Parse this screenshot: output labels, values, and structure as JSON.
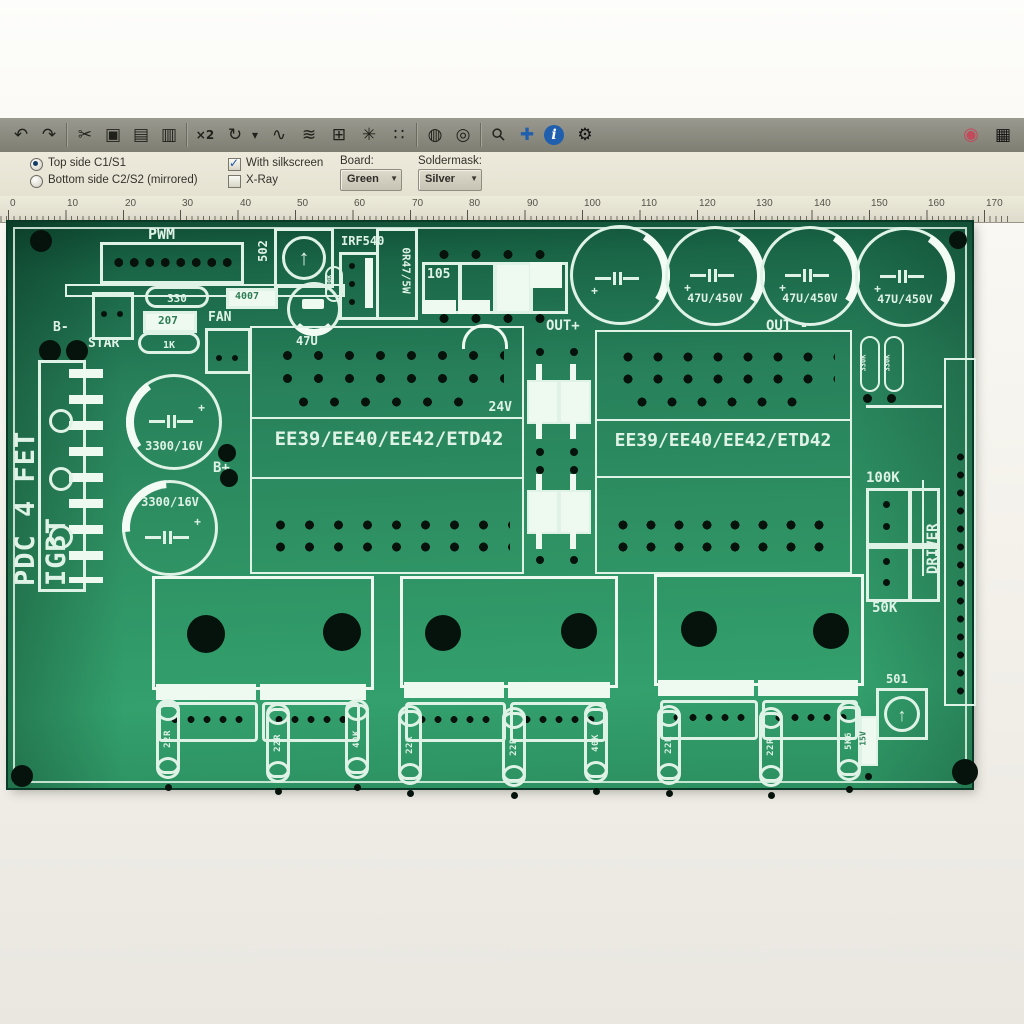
{
  "toolbar": {
    "icons": [
      {
        "name": "undo-icon",
        "glyph": "↶"
      },
      {
        "name": "redo-icon",
        "glyph": "↷"
      },
      {
        "name": "cut-icon",
        "glyph": "✂"
      },
      {
        "name": "copy-icon",
        "glyph": "▣"
      },
      {
        "name": "paste-icon",
        "glyph": "▤"
      },
      {
        "name": "delete-icon",
        "glyph": "▥"
      },
      {
        "name": "scale-x2-icon",
        "glyph": "×2"
      },
      {
        "name": "rotate-icon",
        "glyph": "↻"
      },
      {
        "name": "rotate-dropdown-arrow",
        "glyph": "▾"
      },
      {
        "name": "connection-icon",
        "glyph": "∿"
      },
      {
        "name": "ratsnest-icon",
        "glyph": "≋"
      },
      {
        "name": "route-icon",
        "glyph": "⊞"
      },
      {
        "name": "settings-asterisk-icon",
        "glyph": "✳"
      },
      {
        "name": "footprint-icon",
        "glyph": "∷"
      },
      {
        "name": "plane-icon",
        "glyph": "◍"
      },
      {
        "name": "plane-alt-icon",
        "glyph": "◎"
      },
      {
        "name": "zoom-icon",
        "glyph": "⚲"
      },
      {
        "name": "crosshair-icon",
        "glyph": "✚"
      },
      {
        "name": "info-icon",
        "glyph": "i"
      },
      {
        "name": "gear-icon",
        "glyph": "⚙"
      }
    ],
    "right_icons": [
      {
        "name": "record-icon",
        "glyph": "◉"
      },
      {
        "name": "panel-icon",
        "glyph": "▦"
      }
    ]
  },
  "options": {
    "radio_top": "Top side C1/S1",
    "radio_bottom": "Bottom side C2/S2 (mirrored)",
    "checkbox_silkscreen": "With silkscreen",
    "checkbox_xray": "X-Ray",
    "board_label": "Board:",
    "board_value": "Green",
    "soldermask_label": "Soldermask:",
    "soldermask_value": "Silver"
  },
  "ruler": {
    "ticks": [
      "0",
      "10",
      "20",
      "30",
      "40",
      "50",
      "60",
      "70",
      "80",
      "90",
      "100",
      "110",
      "120",
      "130",
      "140",
      "150",
      "160",
      "170"
    ]
  },
  "board": {
    "silkscreen": {
      "pwm": "PWM",
      "trimmer_top": "502",
      "cap_47u": "47U",
      "r_100k_top": "100K",
      "irf540": "IRF540",
      "shunt": "0R47/5W",
      "cap_105": "105",
      "r_330": "330",
      "d_207": "207",
      "r_1k": "1K",
      "d_4007": "4007",
      "fan": "FAN",
      "b_minus": "B-",
      "star": "STAR",
      "out_plus": "OUT+",
      "out_minus": "OUT -",
      "board_name": "PDC 4 FET IGBT",
      "cap_3300": "3300/16V",
      "b_plus": "B+",
      "v24": "24V",
      "transformer": "EE39/EE40/EE42/ETD42",
      "cap_450v": "47U/450V",
      "r_330k": "330K",
      "r_100k": "100K",
      "r_50k": "50K",
      "driver": "DRIVER",
      "trimmer_bottom": "501",
      "zener": "15V",
      "plus": "+"
    },
    "bottom_resistors": [
      {
        "label": "22R"
      },
      {
        "label": "22R"
      },
      {
        "label": "40K"
      },
      {
        "label": "22R"
      },
      {
        "label": "22R"
      },
      {
        "label": "40K"
      },
      {
        "label": "22R"
      },
      {
        "label": "22R"
      },
      {
        "label": "5K6"
      }
    ]
  },
  "colors": {
    "board_green": "#2e9163",
    "board_green_dark": "#11543a",
    "silkscreen": "#dff2e6",
    "pad_black": "#06130c",
    "toolbar_gray": "#8b897e",
    "panel_beige": "#eae7d8",
    "dropdown_face": "#d3d0c1",
    "info_blue": "#1f5fae",
    "record_red": "#c24a5a"
  }
}
